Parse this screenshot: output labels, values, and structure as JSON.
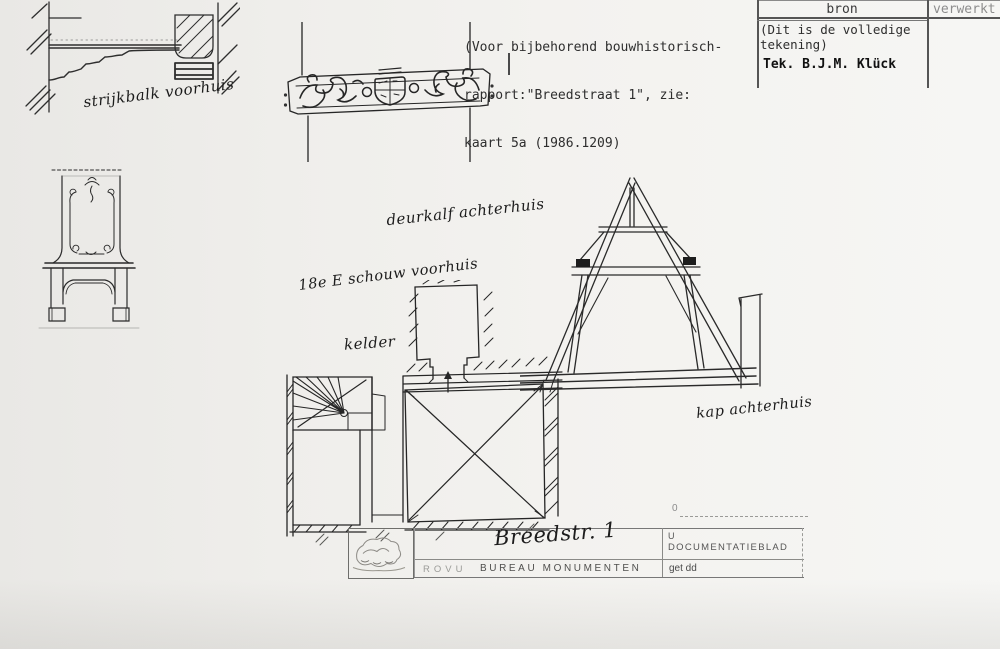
{
  "colors": {
    "paper": "#f0efec",
    "ink": "#222222",
    "faint": "#8c8c8c"
  },
  "note": {
    "line1": "(Voor bijbehorend bouwhistorisch-",
    "line2": "rapport:\"Breedstraat 1\", zie:",
    "line3": "kaart 5a (1986.1209)"
  },
  "source_table": {
    "header_bron": "bron",
    "header_verwerkt": "verwerkt",
    "body_line1": "(Dit is de volledige",
    "body_line2": "tekening)",
    "credit": "Tek. B.J.M. Klück"
  },
  "annotations": {
    "strijkbalk": "strijkbalk voorhuis",
    "deurkalf": "deurkalf achterhuis",
    "schouw": "18e E schouw voorhuis",
    "kelder": "kelder",
    "kap": "kap achterhuis"
  },
  "title_block": {
    "street": "Breedstr. 1",
    "org": "ROVU",
    "bureau": "BUREAU MONUMENTEN",
    "u": "U",
    "doc": "DOCUMENTATIEBLAD",
    "get_dd": "get dd",
    "scale_zero": "0"
  }
}
